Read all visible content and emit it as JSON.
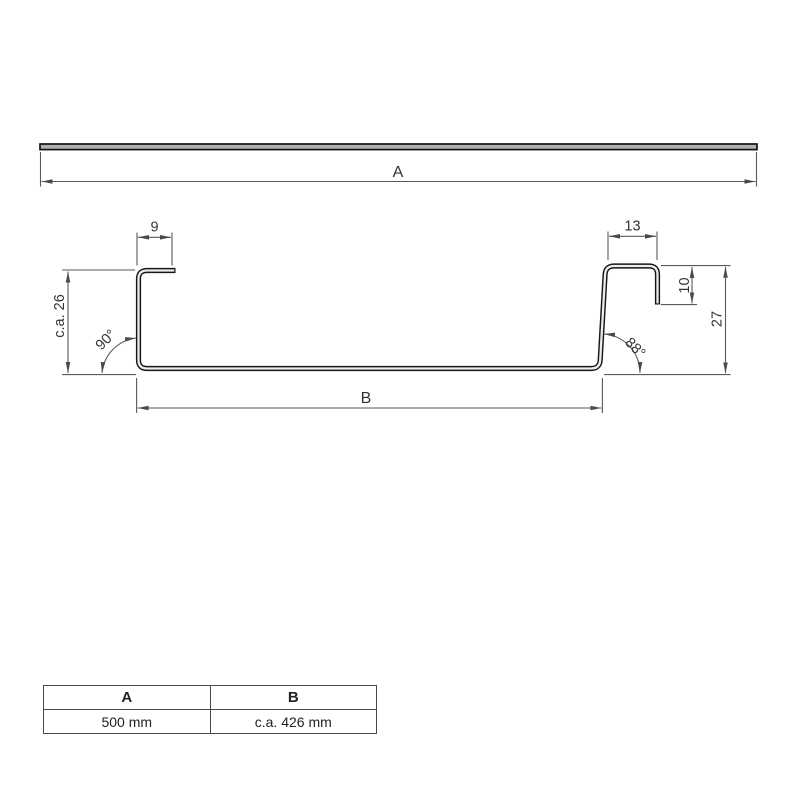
{
  "drawing": {
    "labels": {
      "a": "A",
      "b": "B",
      "dim9": "9",
      "dim13": "13",
      "dim10": "10",
      "dim27": "27",
      "ca26": "c.a. 26",
      "angle_left": "90°",
      "angle_right": "88°"
    },
    "colors": {
      "profile_line": "#161616",
      "dimension_line": "#595959",
      "text": "#333333",
      "bar_fill": "#b0b0b0"
    }
  },
  "table": {
    "headers": [
      "A",
      "B"
    ],
    "values": [
      "500 mm",
      "c.a. 426 mm"
    ]
  }
}
